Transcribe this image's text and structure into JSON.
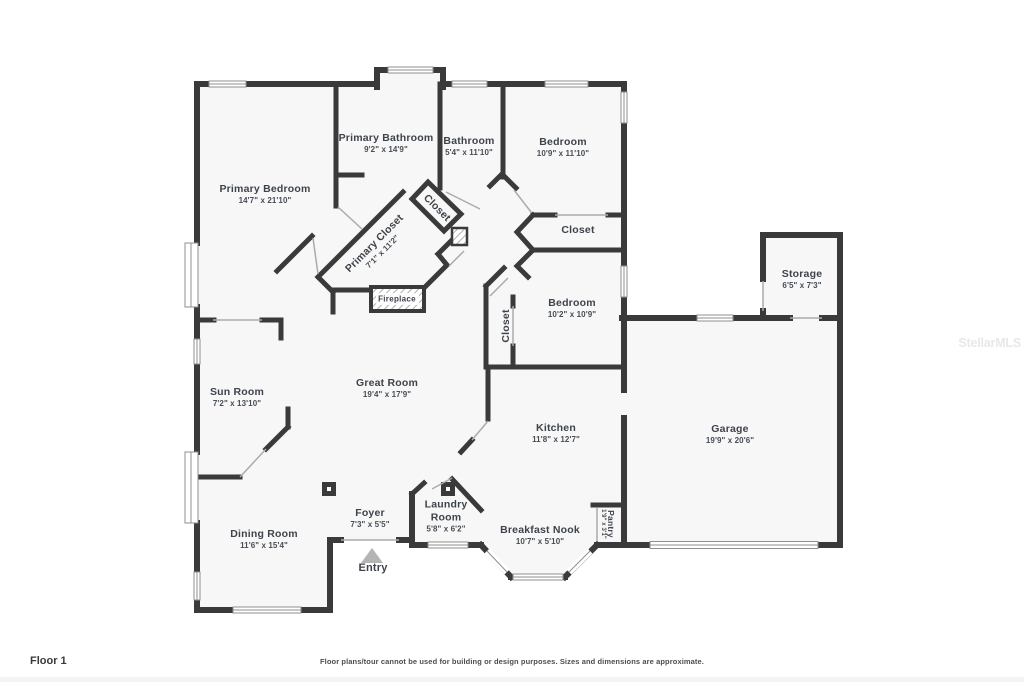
{
  "page": {
    "floor_label": "Floor 1",
    "disclaimer": "Floor plans/tour cannot be used for building or design purposes. Sizes and dimensions are approximate.",
    "watermark": "StellarMLS"
  },
  "colors": {
    "wall": "#3a3a3a",
    "floor": "#f7f7f7",
    "background": "#ffffff",
    "window_line": "#8f8f8f",
    "door_line": "#ababab",
    "label_text": "#3e434b",
    "entry_arrow": "#b4b4b4",
    "watermark": "#e8e8e8"
  },
  "rooms": [
    {
      "name": "Primary Bathroom",
      "dims": "9'2\" x 14'9\""
    },
    {
      "name": "Bathroom",
      "dims": "5'4\" x 11'10\""
    },
    {
      "name": "Bedroom",
      "dims": "10'9\" x 11'10\""
    },
    {
      "name": "Primary Bedroom",
      "dims": "14'7\" x 21'10\""
    },
    {
      "name": "Closet"
    },
    {
      "name": "Primary Closet",
      "dims": "7'1\" x 11'2\""
    },
    {
      "name": "Closet"
    },
    {
      "name": "Storage",
      "dims": "6'5\" x 7'3\""
    },
    {
      "name": "Fireplace"
    },
    {
      "name": "Bedroom",
      "dims": "10'2\" x 10'9\""
    },
    {
      "name": "Closet"
    },
    {
      "name": "Sun Room",
      "dims": "7'2\" x 13'10\""
    },
    {
      "name": "Great Room",
      "dims": "19'4\" x 17'9\""
    },
    {
      "name": "Kitchen",
      "dims": "11'8\" x 12'7\""
    },
    {
      "name": "Garage",
      "dims": "19'9\" x 20'6\""
    },
    {
      "name": "Dining Room",
      "dims": "11'6\" x 15'4\""
    },
    {
      "name": "Foyer",
      "dims": "7'3\" x 5'5\""
    },
    {
      "name": "Laundry Room",
      "dims": "5'8\" x 6'2\""
    },
    {
      "name": "Breakfast Nook",
      "dims": "10'7\" x 5'10\""
    },
    {
      "name": "Pantry",
      "dims": "1'9\" x 3'1\""
    },
    {
      "name": "Entry"
    }
  ]
}
